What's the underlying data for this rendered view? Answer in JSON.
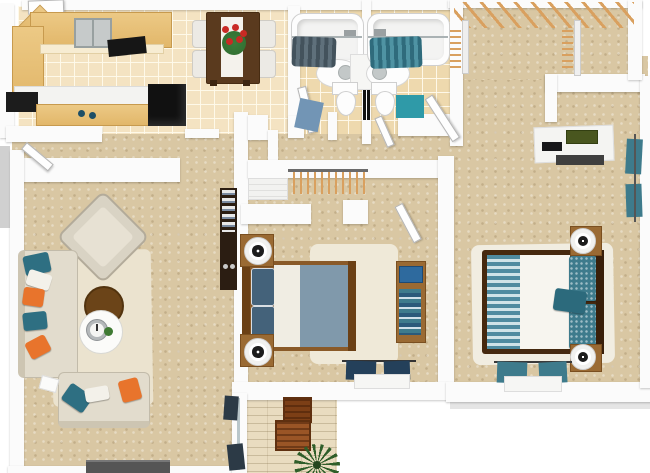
{
  "scene": {
    "title": "3D apartment floor plan render — two bedroom / two bath unit with patio",
    "view": "top-down dollhouse 3D render, no text labels"
  },
  "palette": {
    "canvas": "#ffffff",
    "wall": "#fbfbfb",
    "wall_shadow": "#c9c9c9",
    "carpet": "#d9c7a3",
    "kitchen_tile": "#f4e3c2",
    "bath_tile": "#eed9ae",
    "patio_plank": "#e9dcc0",
    "oak_counter": "#e6bf78",
    "wood_furniture": "#9a6a33",
    "dark_wood": "#5a3a1e",
    "black_appliance": "#141414",
    "teal": "#3e7b8c",
    "bright_teal_mat": "#2f9aa8",
    "soft_blue_mat": "#7295b5",
    "navy_curtain": "#24405a",
    "slate_curtain": "#43525c",
    "orange_pillow": "#e8742c",
    "cream_sofa": "#e2dccd",
    "cream_rug": "#ebe3cf",
    "duvet_blue": "#8099ab",
    "red_flowers": "#c92a24",
    "plant_green": "#2f5e2a",
    "hanger_tan": "#d9a05f",
    "laptop_blue": "#2e6a9e",
    "laptop_olive": "#49561f"
  },
  "rooms": {
    "kitchen": {
      "label": "Kitchen",
      "furniture": [
        "U-shaped oak counter",
        "double-basin steel sink",
        "black cooktop",
        "island with white top",
        "black range front",
        "two blue knobs",
        "black refrigerator"
      ]
    },
    "dining": {
      "label": "Dining Area",
      "furniture": [
        "dark wood table",
        "white table runner",
        "red flower centerpiece",
        "four white chairs"
      ]
    },
    "bathroom_one": {
      "label": "Bathroom 1",
      "furniture": [
        "bathtub",
        "slate shower curtain",
        "oval vanity sink",
        "toilet",
        "blue bath mat",
        "door"
      ]
    },
    "bathroom_two": {
      "label": "Bathroom 2",
      "furniture": [
        "bathtub",
        "teal shower curtain",
        "oval vanity sink",
        "toilet",
        "teal bath mat",
        "door"
      ]
    },
    "walk_in_closet": {
      "label": "Walk-in Closet",
      "furniture": [
        "top hanger rail with wooden hangers",
        "left hanger rod",
        "right hanger rod"
      ]
    },
    "hallway": {
      "label": "Hall / Entry",
      "furniture": [
        "open entry door",
        "threshold",
        "interior doors"
      ]
    },
    "living_room": {
      "label": "Living Room",
      "furniture": [
        "cream sectional sofa",
        "cream loveseat",
        "teal, white and orange accent pillows",
        "rotated cream armchair",
        "round wood coffee table",
        "round white tray table with clock and small plant",
        "cream area rug",
        "gray TV console",
        "sliding patio door with dark curtains",
        "dark bookshelf with books"
      ]
    },
    "bedroom_one": {
      "label": "Bedroom 1",
      "furniture": [
        "bed with steel-blue duvet and navy pillows",
        "wood headboard and footboard",
        "two wood nightstands",
        "two white drum lamps",
        "cream rug",
        "wood desk with blue laptop and books",
        "closet rod with hangers",
        "white dresser",
        "navy window curtains with sill"
      ]
    },
    "bedroom_two": {
      "label": "Bedroom 2",
      "furniture": [
        "bed with white duvet, teal striped runner and teal pillows",
        "dark wood bed frame",
        "two wood nightstands",
        "two white drum lamps",
        "white rug",
        "white desk with olive laptop and black keyboard",
        "teal curtains on south window",
        "teal curtains on east window"
      ]
    },
    "patio": {
      "label": "Patio",
      "furniture": [
        "wood plank floor",
        "two wooden crates",
        "green palm plant"
      ]
    }
  }
}
